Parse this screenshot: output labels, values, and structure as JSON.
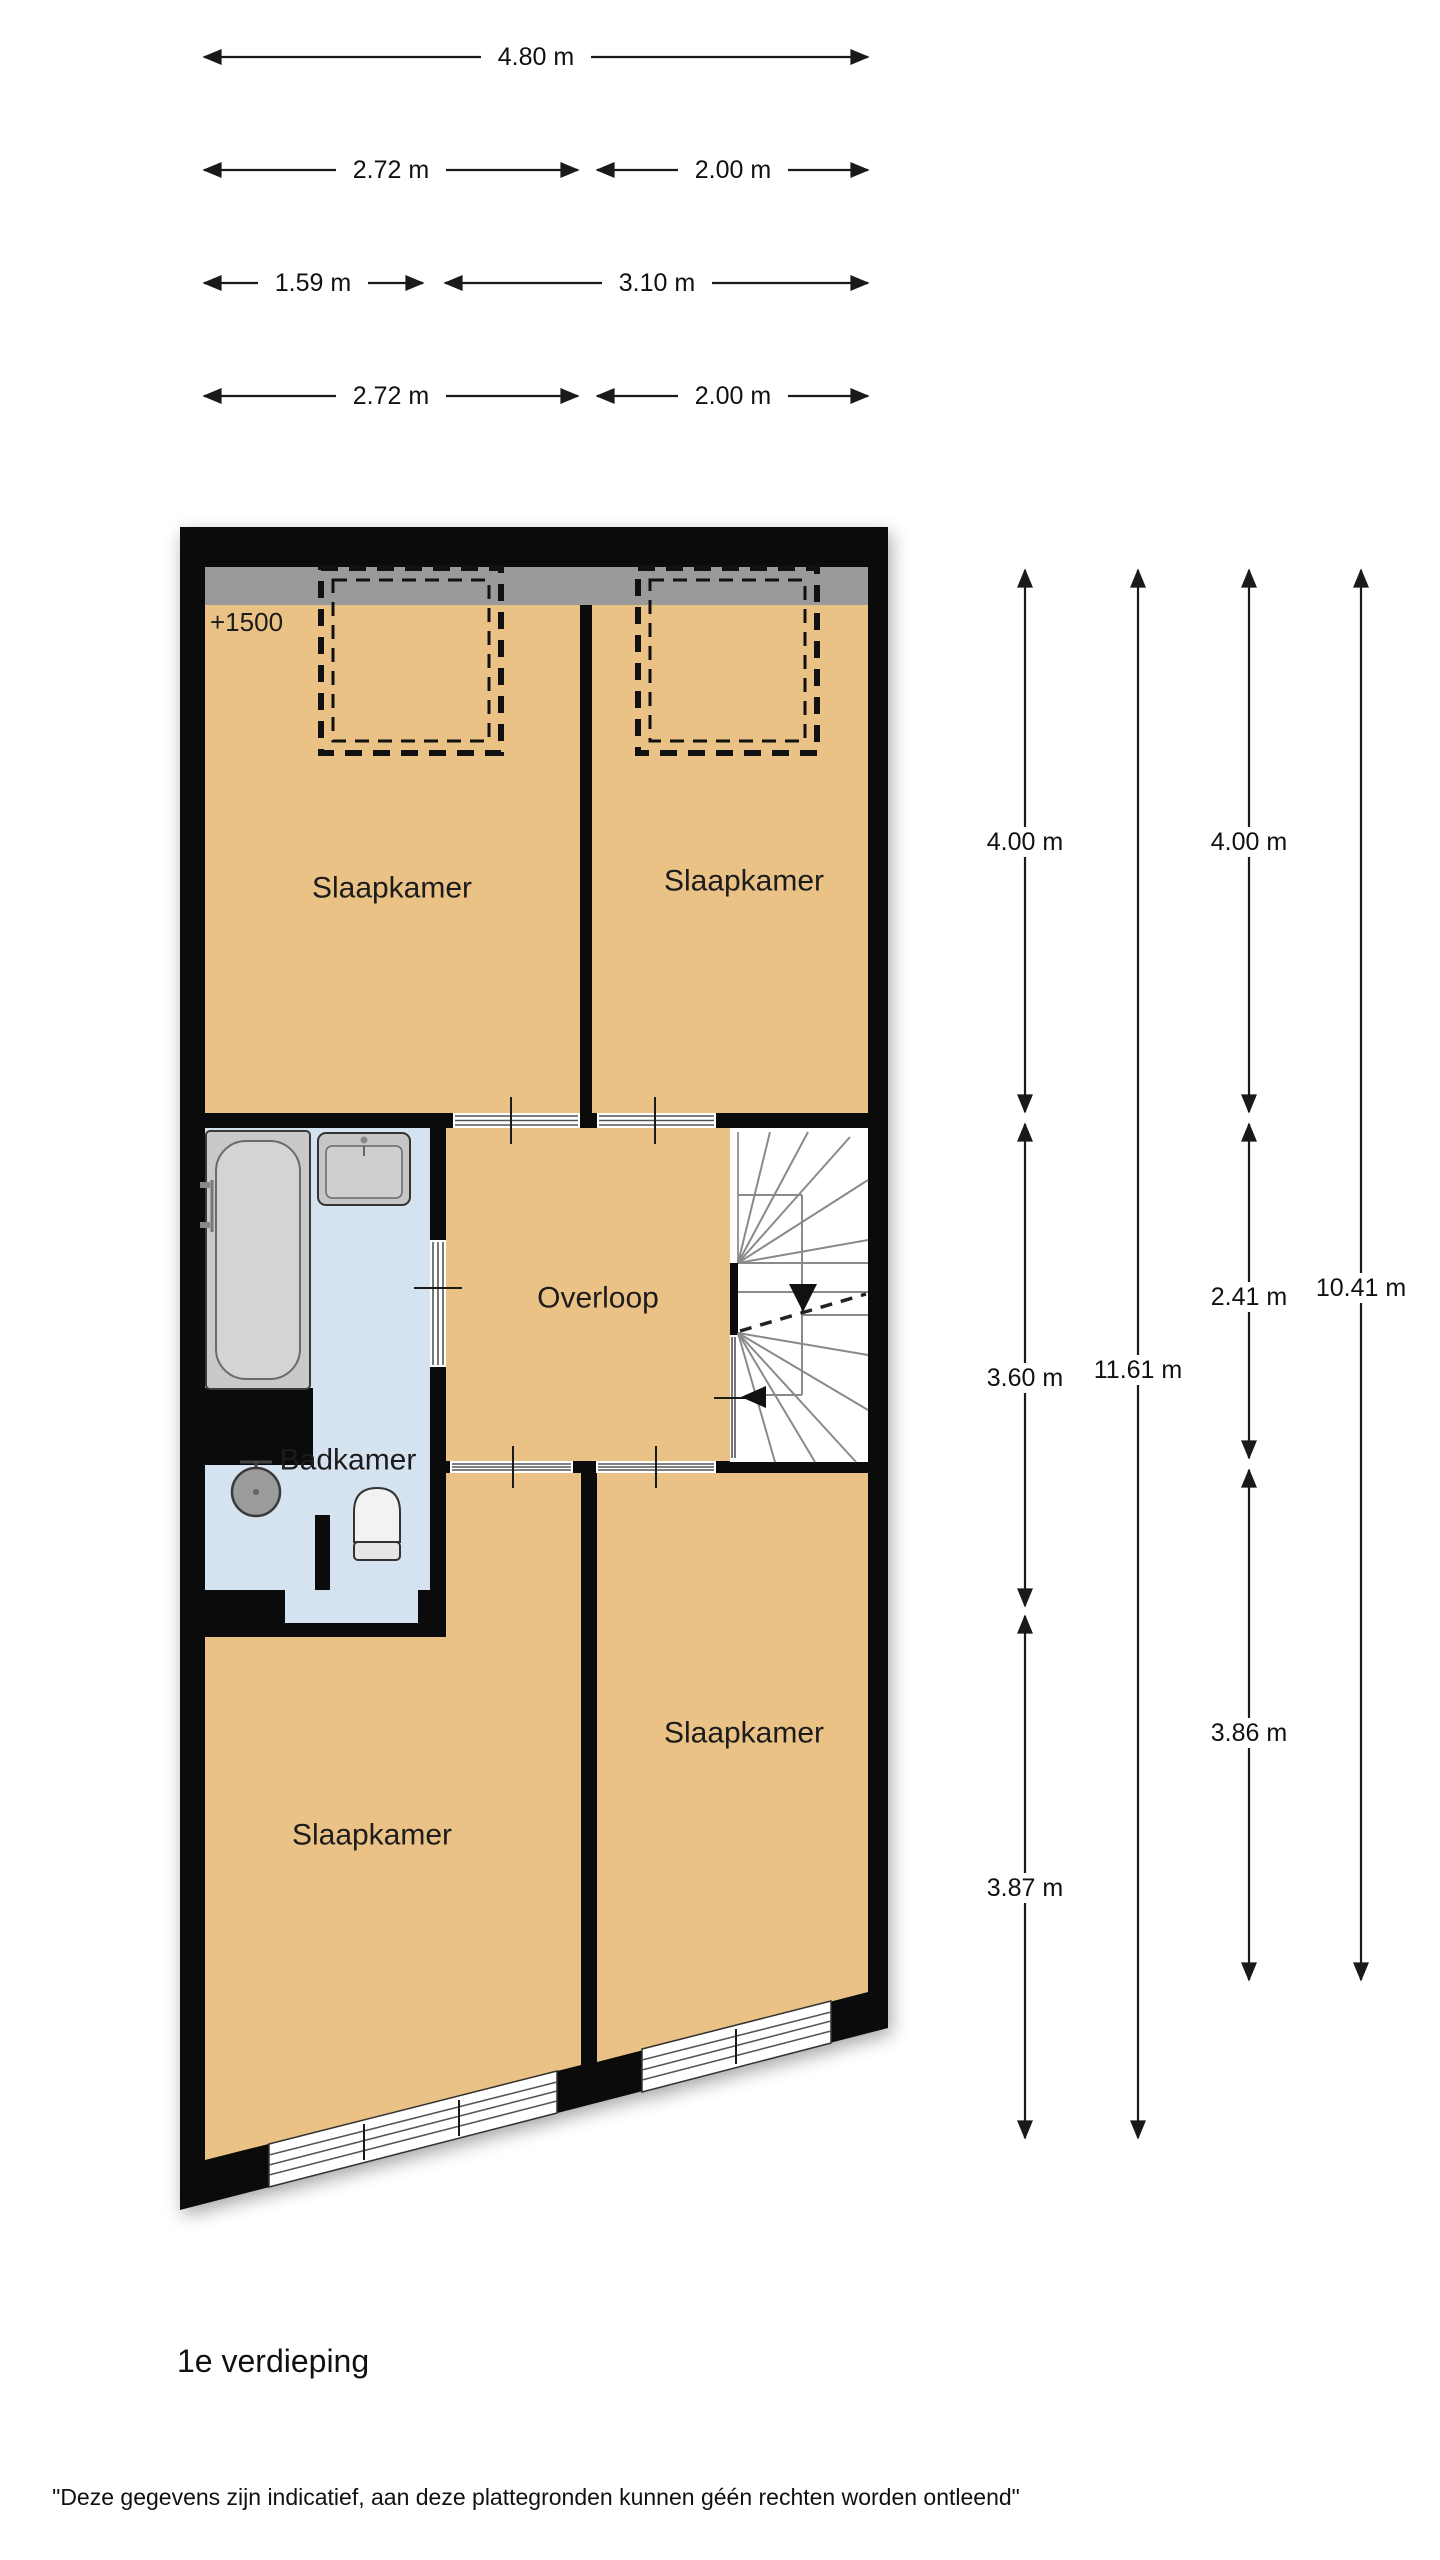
{
  "page": {
    "floor_label": "1e verdieping",
    "disclaimer": "\"Deze gegevens zijn indicatief, aan deze plattegronden kunnen géén rechten worden ontleend\""
  },
  "plan": {
    "annotation": "+1500",
    "rooms": {
      "bedroom_top_left": "Slaapkamer",
      "bedroom_top_right": "Slaapkamer",
      "bedroom_bottom_left": "Slaapkamer",
      "bedroom_bottom_right": "Slaapkamer",
      "landing": "Overloop",
      "bathroom": "Badkamer"
    }
  },
  "dim_labels": {
    "top": [
      "4.80 m",
      "2.72 m",
      "2.00 m",
      "1.59 m",
      "3.10 m",
      "2.72 m",
      "2.00 m"
    ],
    "right": [
      "4.00 m",
      "3.60 m",
      "3.87 m",
      "11.61 m",
      "4.00 m",
      "2.41 m",
      "3.86 m",
      "10.41 m"
    ]
  },
  "colors": {
    "room_fill": "#ebc286",
    "bathroom_fill": "#d5e2ef",
    "low_ceiling_band": "#9a9a9a",
    "wall": "#0b0b0b"
  }
}
